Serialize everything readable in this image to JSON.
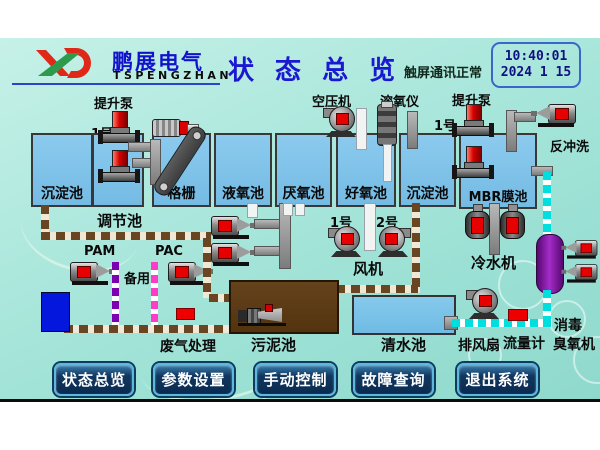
{
  "header": {
    "brand_cn": "鹏展电气",
    "brand_en": "TSPENGZHAN",
    "title": "状 态 总 览",
    "comm_status": "触屏通讯正常",
    "clock_time": "10:40:01",
    "clock_date": "2024 1  15"
  },
  "tanks": [
    {
      "label": "沉淀池"
    },
    {
      "label": "调节池"
    },
    {
      "label": "格栅"
    },
    {
      "label": "液氧池"
    },
    {
      "label": "厌氧池"
    },
    {
      "label": "好氧池"
    },
    {
      "label": "沉淀池"
    },
    {
      "label": "MBR膜池"
    },
    {
      "label": "污泥池"
    },
    {
      "label": "清水池"
    }
  ],
  "labels": {
    "lift_pump_left": "提升泵",
    "lift_pump_right": "提升泵",
    "air_compressor": "空压机",
    "do_meter": "溶氧仪",
    "backwash": "反冲洗",
    "no1": "1号",
    "no2": "2号",
    "pam": "PAM",
    "pac": "PAC",
    "standby": "备用",
    "fan": "风机",
    "chiller": "冷水机",
    "waste_gas": "废气处理",
    "exhaust_fan": "排风扇",
    "flow_meter": "流量计",
    "disinfect": "消毒",
    "ozone": "臭氧机"
  },
  "buttons": [
    {
      "label": "状态总览"
    },
    {
      "label": "参数设置"
    },
    {
      "label": "手动控制"
    },
    {
      "label": "故障查询"
    },
    {
      "label": "退出系统"
    }
  ],
  "colors": {
    "background_teal": "#a8e5da",
    "tank_blue": "#7fc2e8",
    "sludge_brown": "#5d3c17",
    "brand_blue": "#1212cc",
    "button_navy": "#11375f",
    "button_border": "#5fb8dc",
    "pump_red": "#e60000",
    "pipe_brown": "#6a4522",
    "pipe_cyan": "#00dede",
    "pipe_purple": "#7d00b0",
    "pipe_magenta": "#ff3cc8",
    "ozone_purple": "#8a1aaa"
  }
}
